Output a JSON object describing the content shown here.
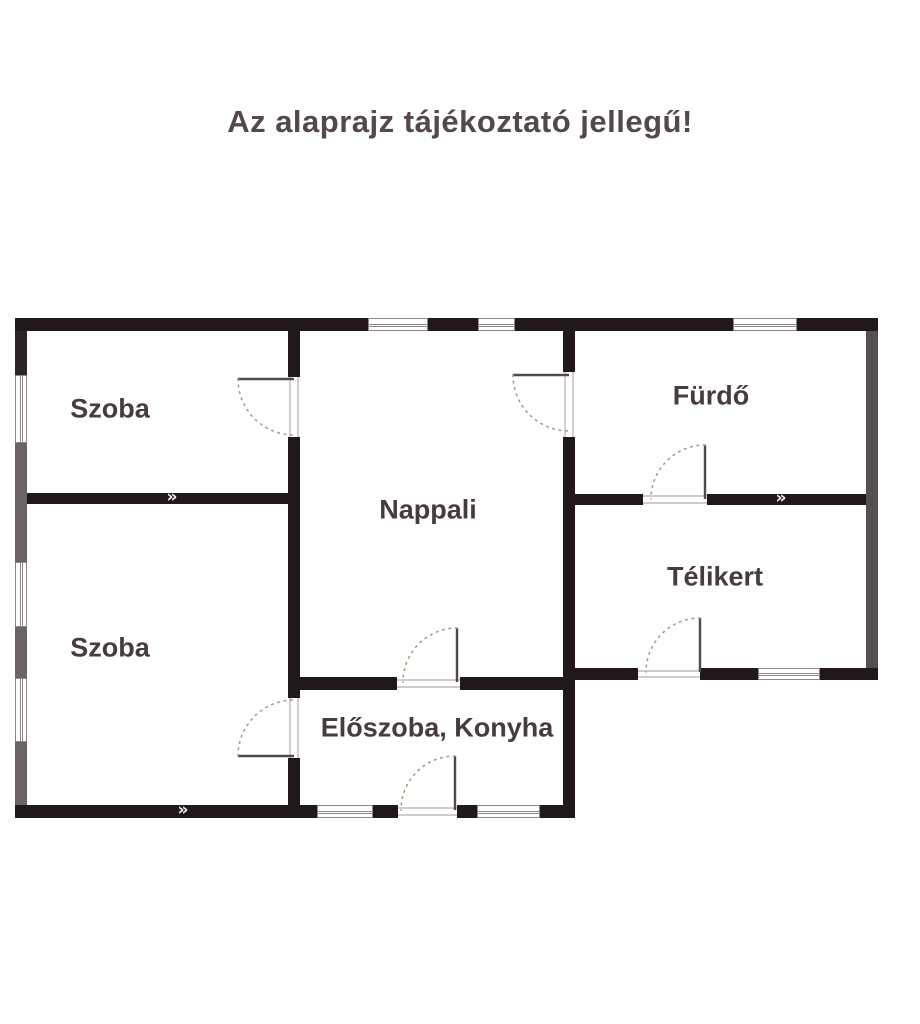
{
  "title": "Az alaprajz tájékoztató jellegű!",
  "rooms": [
    {
      "label": "Szoba"
    },
    {
      "label": "Nappali"
    },
    {
      "label": "Fürdő"
    },
    {
      "label": "Szoba"
    },
    {
      "label": "Télikert"
    },
    {
      "label": "Előszoba, Konyha"
    }
  ],
  "symbols": {
    "wall_vent_chevron": "»"
  },
  "colors": {
    "wall_dark": "#20181c",
    "wall_gray_left": "#6b6367",
    "wall_gray_right": "#554e51",
    "label_text": "#463b3e",
    "title_text": "#52484d",
    "door_arc": "#ab9880",
    "background": "#ffffff"
  }
}
